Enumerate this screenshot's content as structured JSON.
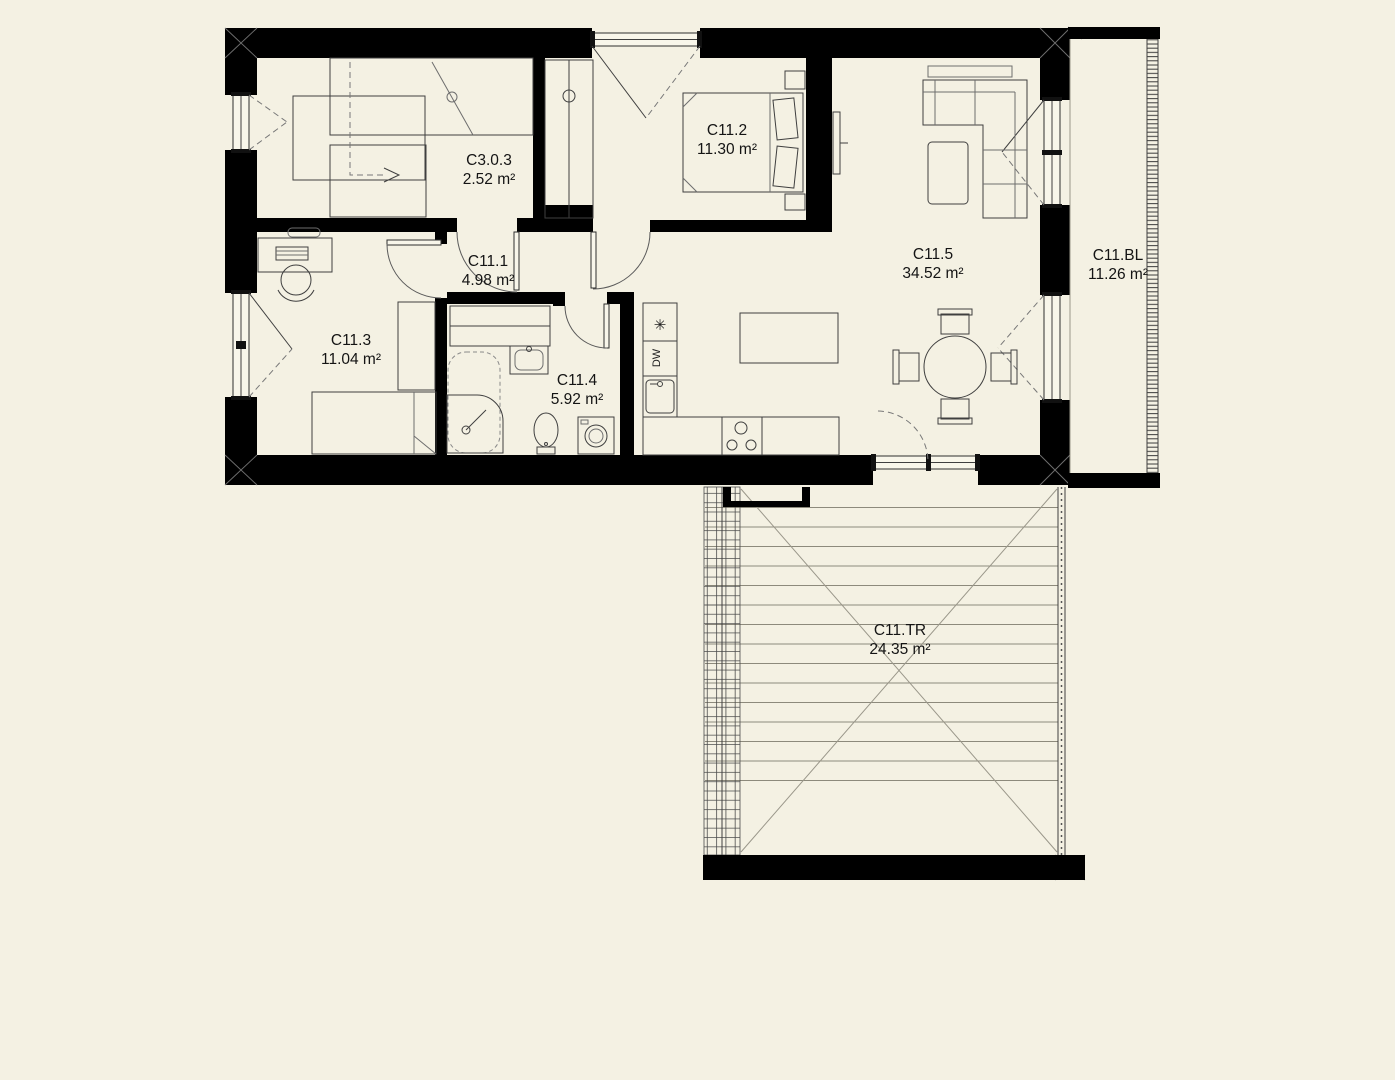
{
  "colors": {
    "background": "#f4f1e3",
    "wall": "#000000",
    "line": "#3f3f3f"
  },
  "rooms": [
    {
      "id": "C3.0.3",
      "area": "2.52 m²"
    },
    {
      "id": "C11.1",
      "area": "4.98 m²"
    },
    {
      "id": "C11.2",
      "area": "11.30 m²"
    },
    {
      "id": "C11.3",
      "area": "11.04 m²"
    },
    {
      "id": "C11.4",
      "area": "5.92 m²"
    },
    {
      "id": "C11.5",
      "area": "34.52 m²"
    },
    {
      "id": "C11.BL",
      "area": "11.26 m²"
    },
    {
      "id": "C11.TR",
      "area": "24.35 m²"
    }
  ],
  "kitchen": {
    "dishwasher_label": "DW",
    "freezer_symbol": "✳"
  }
}
